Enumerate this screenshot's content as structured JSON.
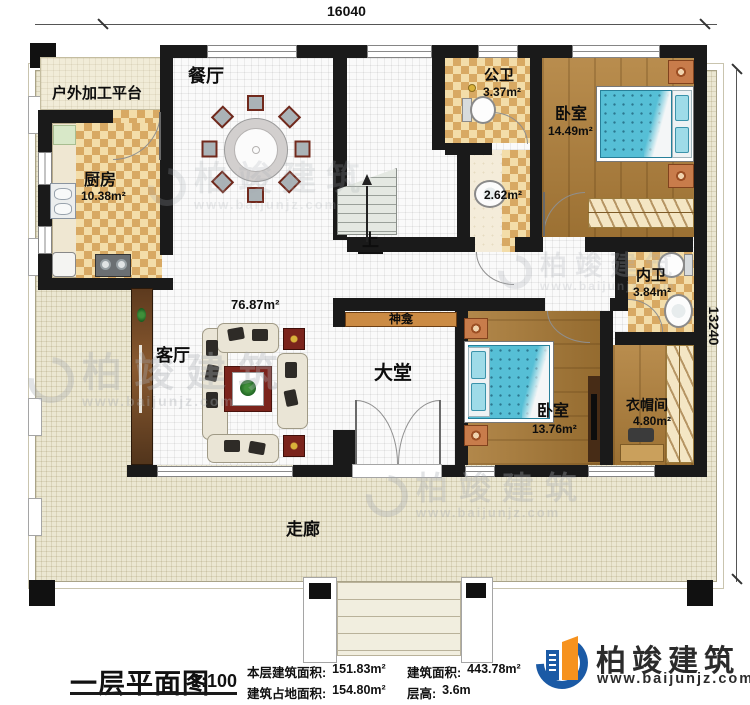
{
  "dimensions": {
    "width_mm": "16040",
    "height_mm": "13240"
  },
  "rooms": {
    "outdoor_platform": {
      "label": "户外加工平台"
    },
    "dining": {
      "label": "餐厅"
    },
    "kitchen": {
      "label": "厨房",
      "area": "10.38m²"
    },
    "public_bath": {
      "label": "公卫",
      "area": "3.37m²"
    },
    "wash_area": {
      "area": "2.62m²"
    },
    "bedroom_top": {
      "label": "卧室",
      "area": "14.49m²"
    },
    "inner_bath": {
      "label": "内卫",
      "area": "3.84m²"
    },
    "living_room": {
      "label": "客厅",
      "area": "76.87m²"
    },
    "shrine": {
      "label": "神龛"
    },
    "hall": {
      "label": "大堂"
    },
    "bedroom_bottom": {
      "label": "卧室",
      "area": "13.76m²"
    },
    "cloakroom": {
      "label": "衣帽间",
      "area": "4.80m²"
    },
    "corridor": {
      "label": "走廊"
    },
    "stairs": {
      "label": "上"
    }
  },
  "title_block": {
    "title": "一层平面图",
    "scale": "1:100",
    "stats": [
      {
        "label": "本层建筑面积:",
        "value": "151.83m²"
      },
      {
        "label": "建筑占地面积:",
        "value": "154.80m²"
      },
      {
        "label": "建筑面积:",
        "value": "443.78m²"
      },
      {
        "label": "层高:",
        "value": "3.6m"
      }
    ]
  },
  "brand": {
    "name": "柏竣建筑",
    "url": "www.baijunjz.com"
  },
  "watermark": {
    "name": "柏竣建筑",
    "url": "www.baijunjz.com"
  },
  "colors": {
    "wall": "#1a1a1a",
    "wood_floor": "#b1803a",
    "tile_accent": "#d8a963",
    "bed": "#56bfd6",
    "brand_blue": "#1b5aa5",
    "brand_orange": "#f6921e"
  }
}
